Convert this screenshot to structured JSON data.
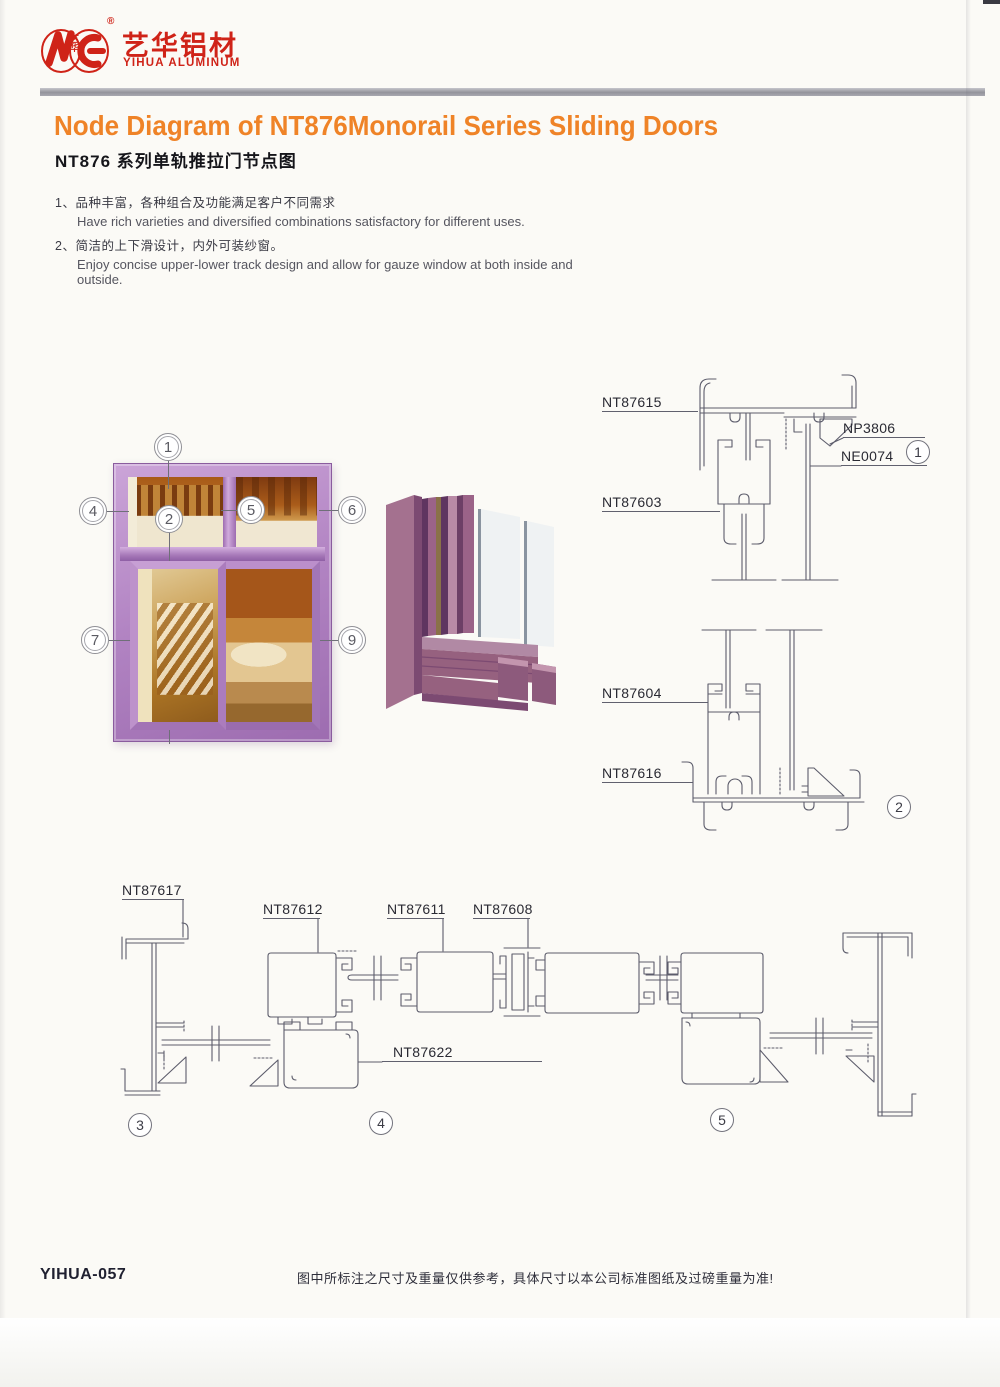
{
  "brand": {
    "name_cn": "艺华铝材",
    "name_en": "YIHUA ALUMINUM",
    "monogram_cn": "艺华",
    "registered": "®"
  },
  "title": {
    "en": "Node Diagram of NT876Monorail Series Sliding Doors",
    "cn": "NT876 系列单轨推拉门节点图"
  },
  "features": [
    {
      "num": "1、",
      "cn": "品种丰富，各种组合及功能满足客户不同需求",
      "en": "Have rich varieties and diversified combinations satisfactory for different uses."
    },
    {
      "num": "2、",
      "cn": "简洁的上下滑设计，内外可装纱窗。",
      "en": "Enjoy concise upper-lower track design and allow for gauze window at both inside and outside."
    }
  ],
  "window_callouts": [
    "1",
    "2",
    "3",
    "4",
    "5",
    "6",
    "7",
    "8",
    "9"
  ],
  "details": {
    "d1": {
      "circle": "1",
      "labels": {
        "top_track": "NT87615",
        "corner_wedge": "NP3806",
        "glass": "NE0074",
        "roller_rail": "NT87603"
      }
    },
    "d2": {
      "circle": "2",
      "labels": {
        "roller_rail": "NT87604",
        "bottom_track": "NT87616"
      }
    },
    "d3": {
      "circle": "3",
      "labels": {
        "side_jamb": "NT87617"
      }
    },
    "d4": {
      "circle": "4",
      "labels": {
        "sash_a": "NT87612",
        "sash_b": "NT87611",
        "interlock": "NT87608",
        "bottom_rail": "NT87622"
      }
    },
    "d5": {
      "circle": "5"
    }
  },
  "footer": {
    "code": "YIHUA-057",
    "disclaimer": "图中所标注之尺寸及重量仅供参考，具体尺寸以本公司标准图纸及过磅重量为准!"
  },
  "colors": {
    "accent_orange": "#ef8327",
    "brand_red": "#cf2318",
    "frame_purple": "#b78cc9",
    "drawing_line": "#5c5c6b"
  }
}
